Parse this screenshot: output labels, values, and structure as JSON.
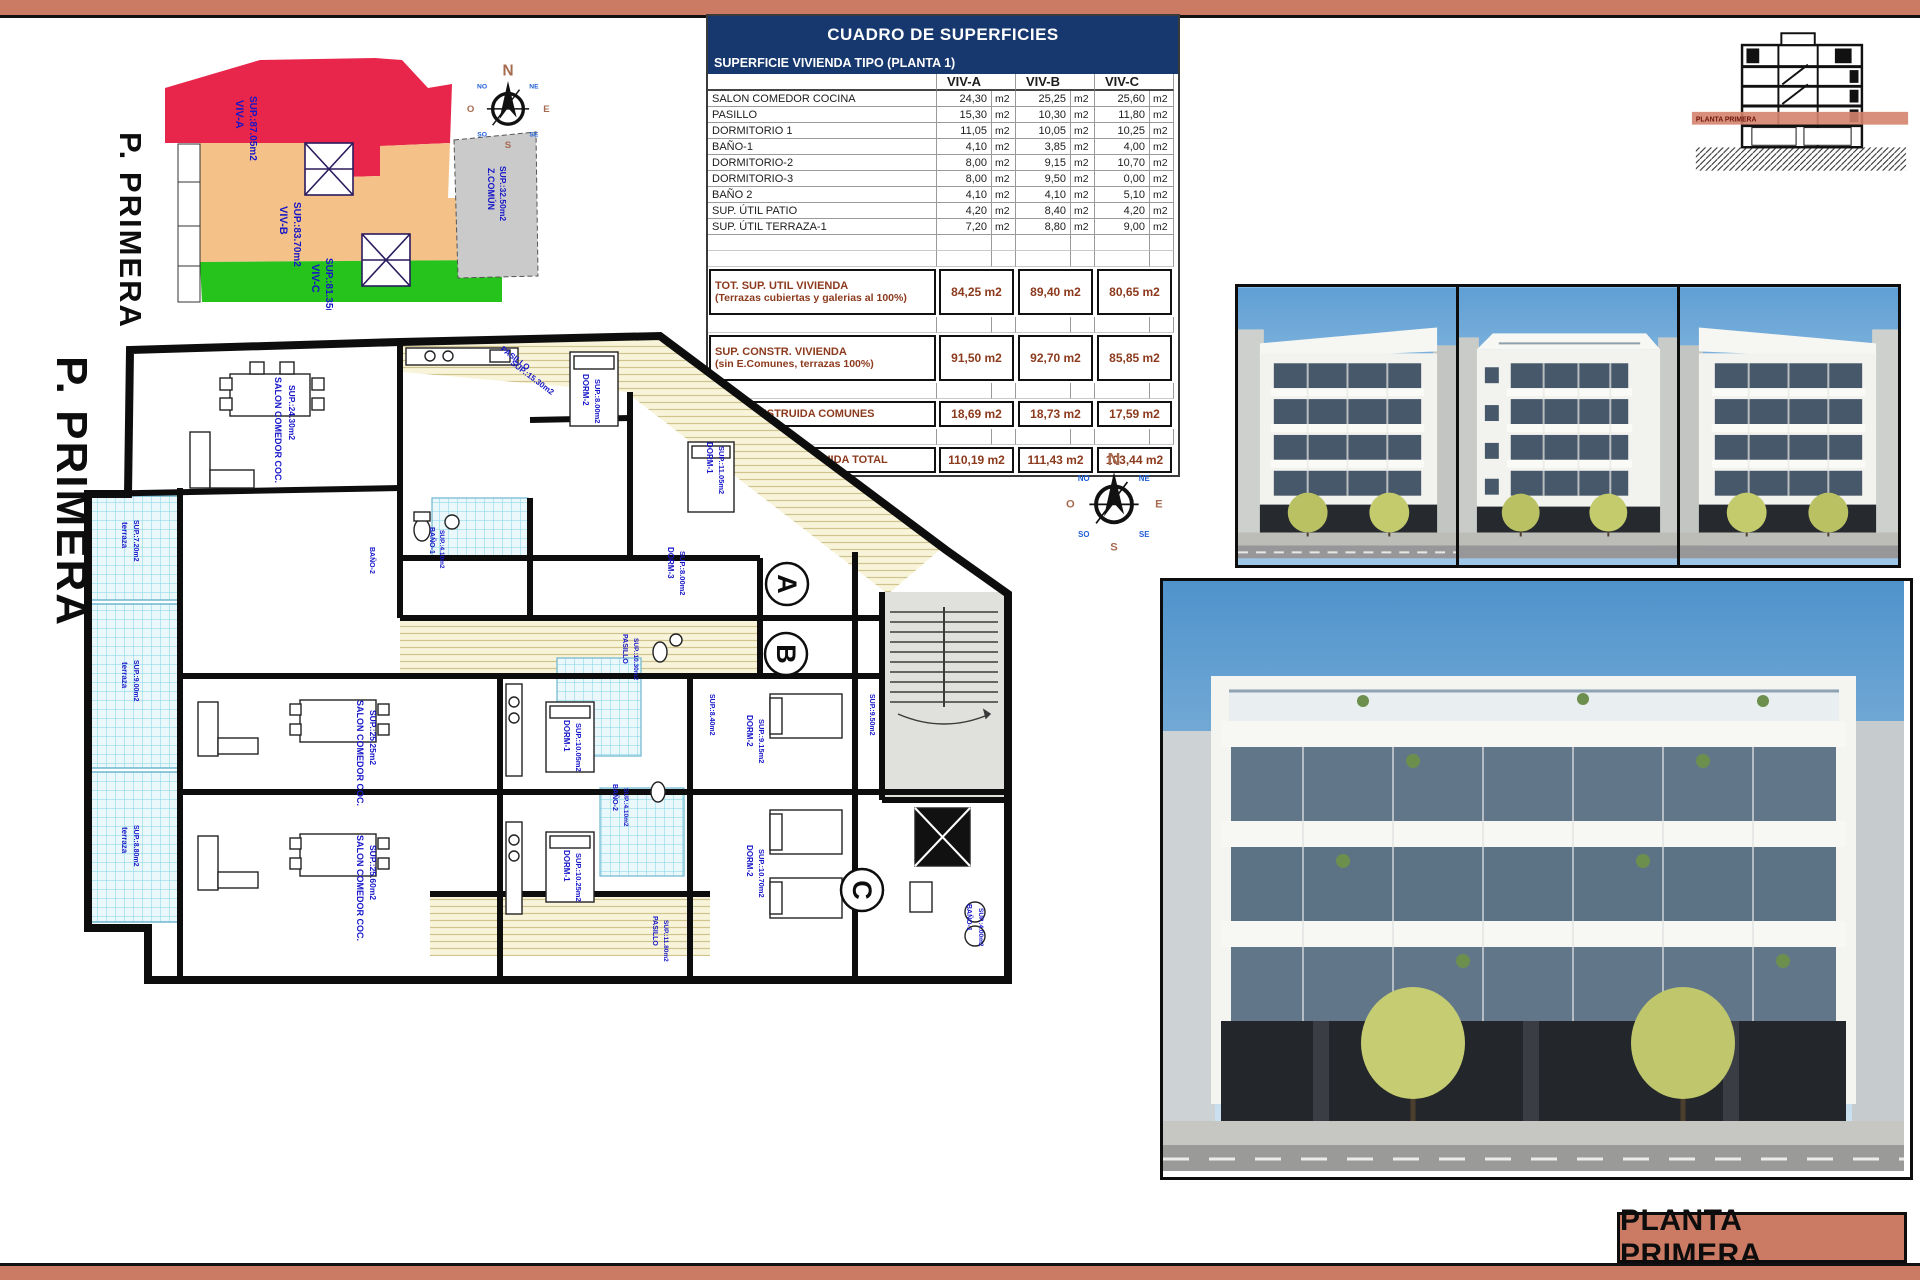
{
  "colors": {
    "page_accent": "#cb7a63",
    "table_header_bg": "#17386e",
    "table_total_text": "#8c3a1d",
    "zone_viv_a": "#e8254a",
    "zone_viv_b": "#f4c289",
    "zone_viv_c": "#25c31b",
    "zone_comun": "#cacaca",
    "plan_label": "#1616c8",
    "section_band": "#d4846e"
  },
  "site_plan": {
    "page_label": "P. PRIMERA",
    "zones": [
      {
        "label": "VIV-A",
        "area": "SUP.:87.05m2"
      },
      {
        "label": "VIV-B",
        "area": "SUP.:83.70m2"
      },
      {
        "label": "VIV-C",
        "area": "SUP.:81.35m2"
      },
      {
        "label": "Z.COMÚN",
        "area": "SUP.:32.50m2"
      }
    ]
  },
  "compass": {
    "n": "N",
    "ne": "NE",
    "e": "E",
    "se": "SE",
    "s": "S",
    "so": "SO",
    "o": "O",
    "no": "NO"
  },
  "areas_table": {
    "title": "CUADRO DE SUPERFICIES",
    "subtitle": "SUPERFICIE VIVIENDA TIPO  (PLANTA 1)",
    "columns": [
      "VIV-A",
      "VIV-B",
      "VIV-C"
    ],
    "unit": "m2",
    "rows": [
      {
        "label": "SALON COMEDOR COCINA",
        "values": [
          "24,30",
          "25,25",
          "25,60"
        ]
      },
      {
        "label": "PASILLO",
        "values": [
          "15,30",
          "10,30",
          "11,80"
        ]
      },
      {
        "label": "DORMITORIO 1",
        "values": [
          "11,05",
          "10,05",
          "10,25"
        ]
      },
      {
        "label": "BAÑO-1",
        "values": [
          "4,10",
          "3,85",
          "4,00"
        ]
      },
      {
        "label": "DORMITORIO-2",
        "values": [
          "8,00",
          "9,15",
          "10,70"
        ]
      },
      {
        "label": "DORMITORIO-3",
        "values": [
          "8,00",
          "9,50",
          "0,00"
        ]
      },
      {
        "label": "BAÑO 2",
        "values": [
          "4,10",
          "4,10",
          "5,10"
        ]
      },
      {
        "label": "SUP. ÚTIL PATIO",
        "values": [
          "4,20",
          "8,40",
          "4,20"
        ]
      },
      {
        "label": "SUP. ÚTIL TERRAZA-1",
        "values": [
          "7,20",
          "8,80",
          "9,00"
        ]
      }
    ],
    "totals": [
      {
        "label": "TOT. SUP. UTIL VIVIENDA",
        "sublabel": "(Terrazas cubiertas y galerias al 100%)",
        "values": [
          "84,25",
          "89,40",
          "80,65"
        ]
      },
      {
        "label": "SUP. CONSTR. VIVIENDA",
        "sublabel": "(sin E.Comunes, terrazas 100%)",
        "values": [
          "91,50",
          "92,70",
          "85,85"
        ]
      },
      {
        "label": "SUP. CONSTRUIDA COMUNES",
        "sublabel": "",
        "values": [
          "18,69",
          "18,73",
          "17,59"
        ]
      },
      {
        "label": "SUPERFIIE CONSTRUIDA TOTAL",
        "sublabel": "",
        "values": [
          "110,19",
          "111,43",
          "103,44"
        ]
      }
    ]
  },
  "section_drawing": {
    "band_label": "PLANTA PRIMERA"
  },
  "floor_plan": {
    "page_label": "P. PRIMERA",
    "unit_markers": [
      {
        "letter": "A",
        "x": 717,
        "y": 262
      },
      {
        "letter": "B",
        "x": 716,
        "y": 332
      },
      {
        "letter": "C",
        "x": 792,
        "y": 568
      }
    ],
    "labels": [
      {
        "t": "SALON COMEDOR COC.",
        "x": 205,
        "y": 55,
        "r": 90,
        "s": 9
      },
      {
        "t": "SUP.:24.30m2",
        "x": 219,
        "y": 63,
        "r": 90,
        "s": 8.5
      },
      {
        "t": "PASILLO",
        "x": 430,
        "y": 28,
        "r": 37,
        "s": 8
      },
      {
        "t": "SUP.:15.30m2",
        "x": 440,
        "y": 42,
        "r": 37,
        "s": 8
      },
      {
        "t": "DORM-2",
        "x": 513,
        "y": 52,
        "r": 90,
        "s": 8
      },
      {
        "t": "SUP.:8.00m2",
        "x": 525,
        "y": 57,
        "r": 90,
        "s": 7.5
      },
      {
        "t": "DORM-1",
        "x": 637,
        "y": 120,
        "r": 90,
        "s": 8
      },
      {
        "t": "SUP.:11.05m2",
        "x": 649,
        "y": 124,
        "r": 90,
        "s": 7.5
      },
      {
        "t": "BAÑO-1",
        "x": 360,
        "y": 205,
        "r": 90,
        "s": 7
      },
      {
        "t": "SUP.:4.10m2",
        "x": 370,
        "y": 208,
        "r": 90,
        "s": 6.5
      },
      {
        "t": "BAÑO-2",
        "x": 300,
        "y": 225,
        "r": 90,
        "s": 7
      },
      {
        "t": "DORM-3",
        "x": 598,
        "y": 225,
        "r": 90,
        "s": 8
      },
      {
        "t": "SUP.:8.00m2",
        "x": 610,
        "y": 229,
        "r": 90,
        "s": 7.5
      },
      {
        "t": "terraza",
        "x": 52,
        "y": 200,
        "r": 90,
        "s": 8
      },
      {
        "t": "SUP.:7.20m2",
        "x": 64,
        "y": 198,
        "r": 90,
        "s": 7
      },
      {
        "t": "terraza",
        "x": 52,
        "y": 340,
        "r": 90,
        "s": 8
      },
      {
        "t": "SUP.:9.00m2",
        "x": 64,
        "y": 338,
        "r": 90,
        "s": 7
      },
      {
        "t": "terraza",
        "x": 52,
        "y": 505,
        "r": 90,
        "s": 8
      },
      {
        "t": "SUP.:8.80m2",
        "x": 64,
        "y": 503,
        "r": 90,
        "s": 7
      },
      {
        "t": "SALON COMEDOR COC.",
        "x": 287,
        "y": 378,
        "r": 90,
        "s": 9
      },
      {
        "t": "SUP.:25.25m2",
        "x": 300,
        "y": 388,
        "r": 90,
        "s": 8.5
      },
      {
        "t": "SALON COMEDOR COC.",
        "x": 287,
        "y": 513,
        "r": 90,
        "s": 9
      },
      {
        "t": "SUP.:25.60m2",
        "x": 300,
        "y": 523,
        "r": 90,
        "s": 8.5
      },
      {
        "t": "DORM-1",
        "x": 494,
        "y": 398,
        "r": 90,
        "s": 8
      },
      {
        "t": "SUP.:10.05m2",
        "x": 506,
        "y": 401,
        "r": 90,
        "s": 7.5
      },
      {
        "t": "DORM-1",
        "x": 494,
        "y": 528,
        "r": 90,
        "s": 8
      },
      {
        "t": "SUP.:10.25m2",
        "x": 506,
        "y": 531,
        "r": 90,
        "s": 7.5
      },
      {
        "t": "DORM-2",
        "x": 677,
        "y": 393,
        "r": 90,
        "s": 8
      },
      {
        "t": "SUP.:9.15m2",
        "x": 689,
        "y": 397,
        "r": 90,
        "s": 7.5
      },
      {
        "t": "DORM-2",
        "x": 677,
        "y": 523,
        "r": 90,
        "s": 8
      },
      {
        "t": "SUP.:10.70m2",
        "x": 689,
        "y": 527,
        "r": 90,
        "s": 7.5
      },
      {
        "t": "PASILLO",
        "x": 553,
        "y": 312,
        "r": 90,
        "s": 7
      },
      {
        "t": "SUP.:10.30m2",
        "x": 564,
        "y": 316,
        "r": 90,
        "s": 6.5
      },
      {
        "t": "PASILLO",
        "x": 583,
        "y": 594,
        "r": 90,
        "s": 7
      },
      {
        "t": "SUP.:11.80m2",
        "x": 594,
        "y": 598,
        "r": 90,
        "s": 6.5
      },
      {
        "t": "SUP.:9.50m2",
        "x": 800,
        "y": 372,
        "r": 90,
        "s": 7
      },
      {
        "t": "SUP.:8.40m2",
        "x": 640,
        "y": 372,
        "r": 90,
        "s": 7
      },
      {
        "t": "BAÑO-2",
        "x": 543,
        "y": 462,
        "r": 90,
        "s": 7
      },
      {
        "t": "SUP.:4.10m2",
        "x": 554,
        "y": 466,
        "r": 90,
        "s": 6.5
      },
      {
        "t": "BAÑO-1",
        "x": 897,
        "y": 582,
        "r": 90,
        "s": 7
      },
      {
        "t": "SUP.:4.00m2",
        "x": 909,
        "y": 586,
        "r": 90,
        "s": 6.5
      }
    ]
  },
  "title_block": {
    "label": "PLANTA PRIMERA"
  }
}
